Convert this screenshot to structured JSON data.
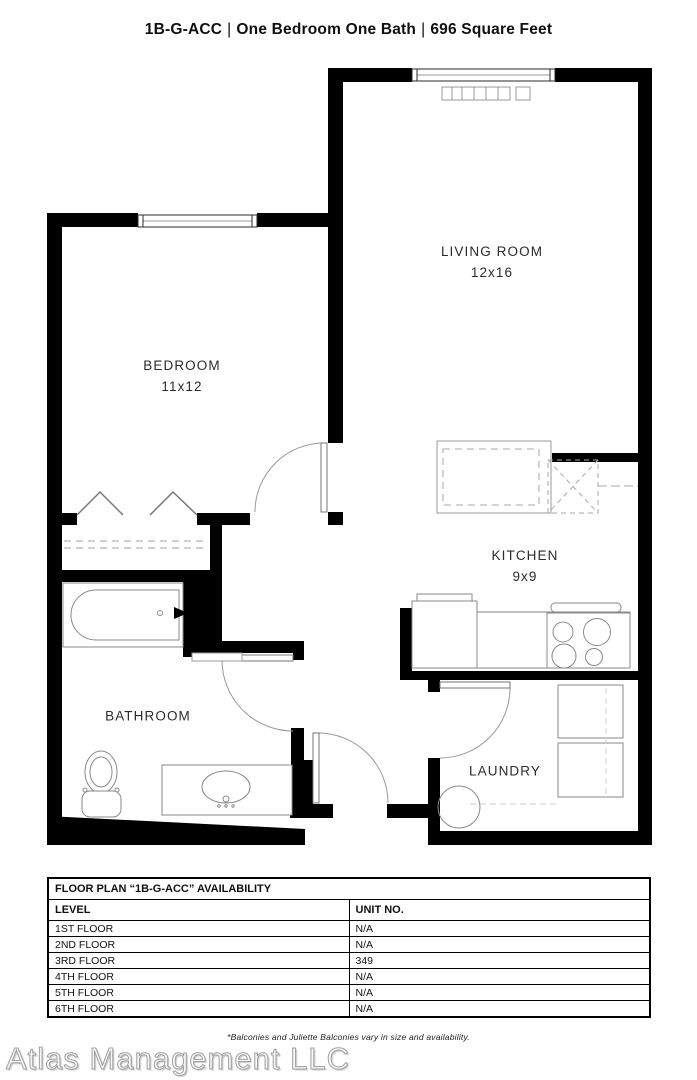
{
  "title": {
    "unit_code": "1B-G-ACC",
    "separator": "|",
    "description": "One Bedroom One Bath",
    "area": "696 Square Feet"
  },
  "rooms": {
    "living_room": {
      "name": "LIVING ROOM",
      "dimensions": "12x16"
    },
    "bedroom": {
      "name": "BEDROOM",
      "dimensions": "11x12"
    },
    "kitchen": {
      "name": "KITCHEN",
      "dimensions": "9x9"
    },
    "bathroom": {
      "name": "BATHROOM"
    },
    "laundry": {
      "name": "LAUNDRY"
    }
  },
  "availability_table": {
    "title": "FLOOR PLAN “1B-G-ACC” AVAILABILITY",
    "columns": {
      "level": "LEVEL",
      "unit": "UNIT NO."
    },
    "rows": [
      {
        "level": "1ST FLOOR",
        "unit": "N/A"
      },
      {
        "level": "2ND FLOOR",
        "unit": "N/A"
      },
      {
        "level": "3RD FLOOR",
        "unit": "349"
      },
      {
        "level": "4TH FLOOR",
        "unit": "N/A"
      },
      {
        "level": "5TH FLOOR",
        "unit": "N/A"
      },
      {
        "level": "6TH FLOOR",
        "unit": "N/A"
      }
    ]
  },
  "footnote": "*Balconies and Juliette Balconies vary in size and availability.",
  "watermark": "Atlas Management LLC",
  "colors": {
    "wall": "#000000",
    "fixture_line": "#8a8a8a",
    "door_arc": "#999999",
    "text": "#111111"
  }
}
